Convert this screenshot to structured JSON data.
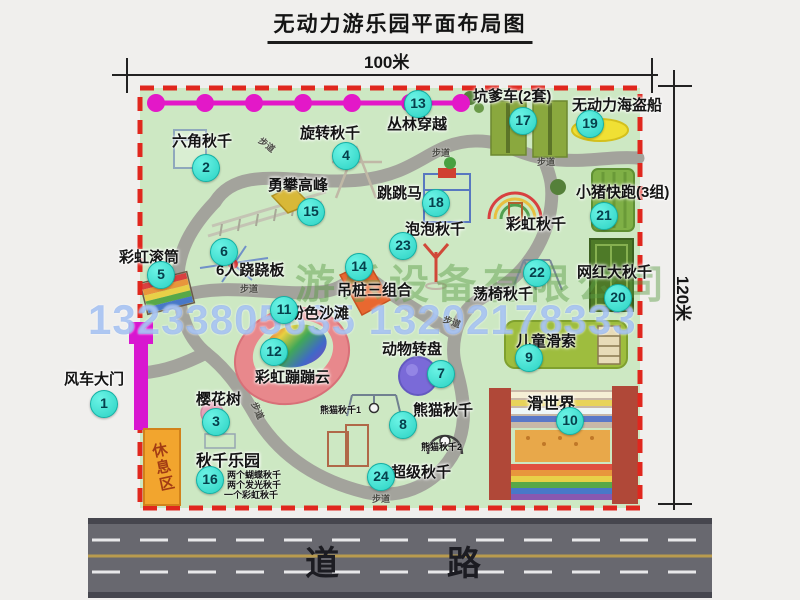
{
  "title": "无动力游乐园平面布局图",
  "dimensions": {
    "width_label": "100米",
    "height_label": "120米"
  },
  "road": {
    "label": "道    路"
  },
  "watermark": {
    "company": "游乐设备有限公司",
    "phone": "13233805635 13202178333"
  },
  "rest_area": {
    "label": "休息区"
  },
  "misc": {
    "trail": "步道"
  },
  "extra_labels": {
    "rainbow_swing": "彩虹秋千",
    "panda_swing_1": "熊猫秋千1",
    "panda_swing_2": "熊猫秋千2"
  },
  "attractions": [
    {
      "num": "1",
      "label": "风车大门"
    },
    {
      "num": "2",
      "label": "六角秋千"
    },
    {
      "num": "3",
      "label": "樱花树"
    },
    {
      "num": "4",
      "label": "旋转秋千"
    },
    {
      "num": "5",
      "label": "彩虹滚筒"
    },
    {
      "num": "6",
      "label": "6人跷跷板"
    },
    {
      "num": "7",
      "label": "动物转盘"
    },
    {
      "num": "8",
      "label": "熊猫秋千"
    },
    {
      "num": "9",
      "label": "儿童滑索"
    },
    {
      "num": "10",
      "label": "滑世界"
    },
    {
      "num": "11",
      "label": "粉色沙滩"
    },
    {
      "num": "12",
      "label": "彩虹蹦蹦云"
    },
    {
      "num": "13",
      "label": "丛林穿越"
    },
    {
      "num": "14",
      "label": "吊桩三组合"
    },
    {
      "num": "15",
      "label": "勇攀高峰"
    },
    {
      "num": "16",
      "label": "秋千乐园",
      "notes": [
        "两个蝴蝶秋千",
        "两个发光秋千",
        "一个彩虹秋千"
      ]
    },
    {
      "num": "17",
      "label": "坑爹车(2套)"
    },
    {
      "num": "18",
      "label": "跳跳马"
    },
    {
      "num": "19",
      "label": "无动力海盗船"
    },
    {
      "num": "20",
      "label": "网红大秋千"
    },
    {
      "num": "21",
      "label": "小猪快跑(3组)"
    },
    {
      "num": "22",
      "label": "荡椅秋千"
    },
    {
      "num": "23",
      "label": "泡泡秋千"
    },
    {
      "num": "24",
      "label": "超级秋千"
    }
  ],
  "colors": {
    "map_green": "#cde8c3",
    "border_red": "#e0271e",
    "badge_cyan": "#2bd2c3",
    "chain_magenta": "#e318c8",
    "gate_magenta": "#d816d0",
    "road_gray": "#68686f",
    "road_yellow": "#b99b4e",
    "rest_orange": "#f2a52e"
  }
}
